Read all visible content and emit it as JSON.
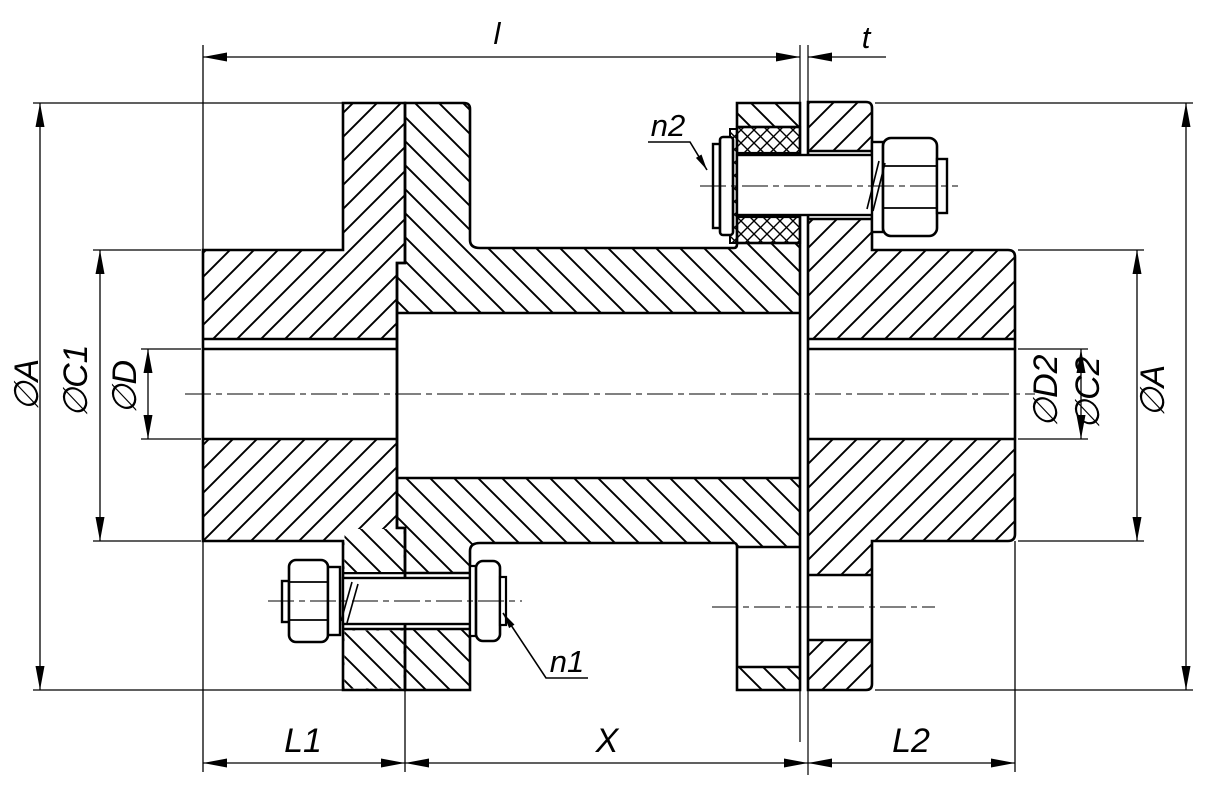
{
  "drawing": {
    "kind": "engineering-section-flange-coupling",
    "colors": {
      "line": "#000000",
      "background": "#ffffff"
    },
    "labels": {
      "dia_a_left": "∅A",
      "dia_c1": "∅C1",
      "dia_d": "∅D",
      "len_l": "l",
      "thk_t": "t",
      "pin_n2": "n2",
      "pin_n1": "n1",
      "dia_d2": "∅D2",
      "dia_c2": "∅C2",
      "dia_a_right": "∅A",
      "len_l1": "L1",
      "len_x": "X",
      "len_l2": "L2"
    }
  }
}
